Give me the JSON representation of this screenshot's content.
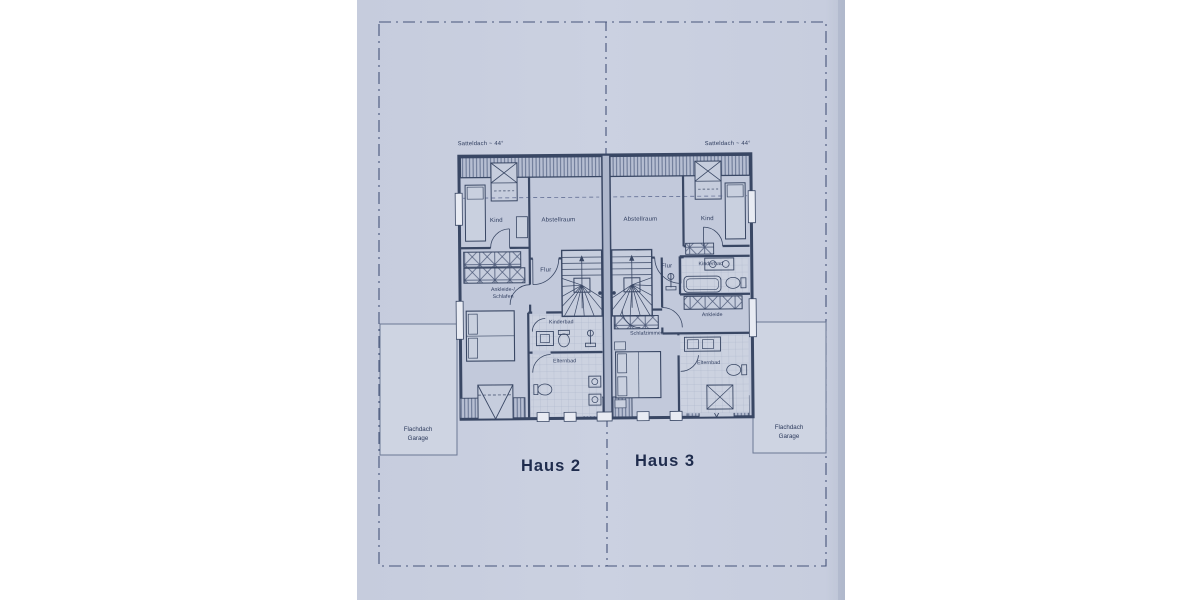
{
  "colors": {
    "paper": "#c9cfdf",
    "paper_edge": "#b9c0d2",
    "ink": "#394764",
    "thin_ink": "#5b688a",
    "text": "#2c3a5c",
    "room_fill": "#c2c9db",
    "tile_fill": "#ccd2e0",
    "hatch_fill": "#b6bed2",
    "garage_fill": "#ced4e2"
  },
  "notes": {
    "roof_left": "Satteldach ~ 44°",
    "roof_right": "Satteldach ~ 44°"
  },
  "garages": {
    "left": {
      "line1": "Flachdach",
      "line2": "Garage"
    },
    "right": {
      "line1": "Flachdach",
      "line2": "Garage"
    }
  },
  "haus2": {
    "name": "Haus 2",
    "rooms": {
      "kind": "Kind",
      "abstellraum": "Abstellraum",
      "flur": "Flur",
      "ankleide1": "Ankleide-/",
      "ankleide2": "Schlafen",
      "kinderbad": "Kinderbad",
      "elternbad": "Elternbad"
    }
  },
  "haus3": {
    "name": "Haus 3",
    "rooms": {
      "abstellraum": "Abstellraum",
      "kind": "Kind",
      "flur": "Flur",
      "kinderbad": "Kinderbad",
      "ankleide": "Ankleide",
      "schlafzimmer": "Schlafzimmer",
      "elternbad": "Elternbad"
    }
  }
}
